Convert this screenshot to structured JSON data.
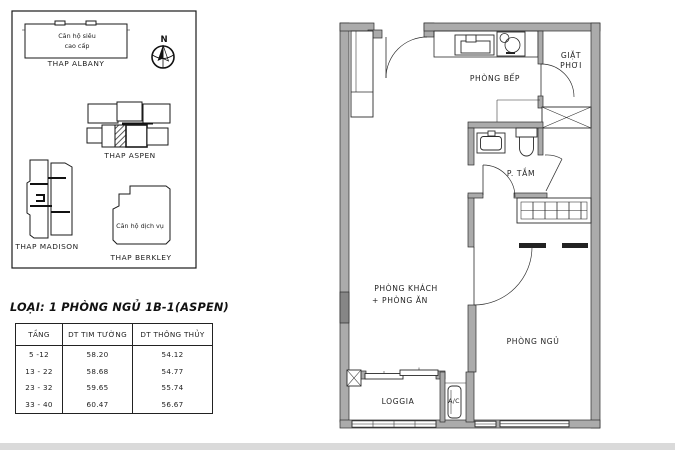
{
  "site_plan": {
    "compass": {
      "label": "N"
    },
    "towers": {
      "albany": {
        "name": "THAP ALBANY",
        "note_line1": "Căn hộ siêu",
        "note_line2": "cao cấp"
      },
      "aspen": {
        "name": "THAP ASPEN"
      },
      "madison": {
        "name": "THAP MADISON"
      },
      "berkley": {
        "name": "THAP BERKLEY",
        "note": "Căn hộ dịch vụ"
      }
    }
  },
  "unit_info": {
    "title": "LOẠI: 1 PHÒNG NGỦ 1B-1(ASPEN)"
  },
  "area_table": {
    "headers": [
      "TẦNG",
      "DT TIM TƯỜNG",
      "DT THÔNG THỦY"
    ],
    "rows": [
      [
        "5 -12",
        "58.20",
        "54.12"
      ],
      [
        "13 - 22",
        "58.68",
        "54.77"
      ],
      [
        "23 - 32",
        "59.65",
        "55.74"
      ],
      [
        "33 - 40",
        "60.47",
        "56.67"
      ]
    ]
  },
  "floor_plan": {
    "rooms": {
      "kitchen": "PHÒNG BẾP",
      "laundry_line1": "GIẶT",
      "laundry_line2": "PHƠI",
      "bathroom": "P. TẮM",
      "living_line1": "PHÒNG KHÁCH",
      "living_line2": "+ PHÒNG ĂN",
      "bedroom": "PHÒNG NGỦ",
      "loggia": "LOGGIA",
      "ac": "A/C"
    }
  },
  "colors": {
    "wall_gray": "#ababab",
    "wall_dark_gray": "#868686",
    "line": "#2b2b2b",
    "background": "#ffffff",
    "footer_strip": "#dadada"
  }
}
